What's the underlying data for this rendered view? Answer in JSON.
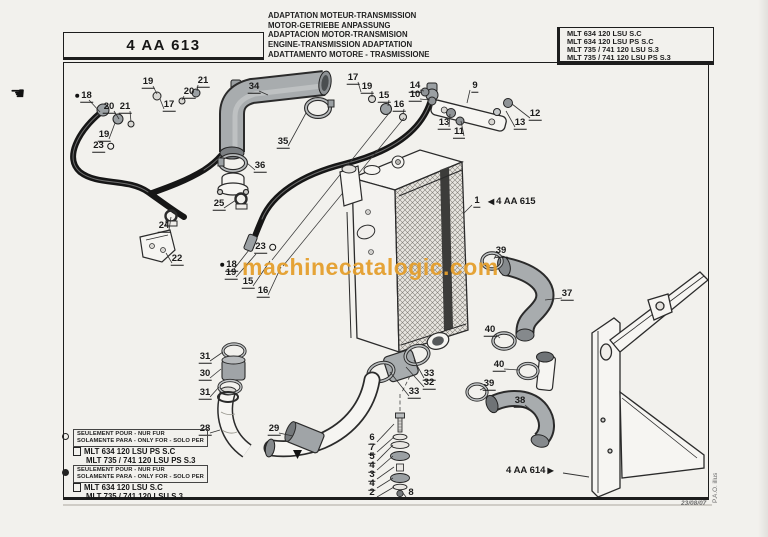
{
  "page": {
    "doc_ref": "4 AA 613",
    "titles": [
      "ADAPTATION MOTEUR-TRANSMISSION",
      "MOTOR-GETRIEBE ANPASSUNG",
      "ADAPTACION MOTOR-TRANSMISION",
      "ENGINE-TRANSMISSION ADAPTATION",
      "ADATTAMENTO MOTORE - TRASMISSIONE"
    ],
    "models": [
      "MLT 634 120 LSU  S.C",
      "MLT 634 120 LSU PS S.C",
      "MLT 735 / 741 120 LSU S.3",
      "MLT 735 / 741 120 LSU PS S.3"
    ],
    "footer_date": "23/08/07",
    "side_note": "P.A.O. illus"
  },
  "watermark": {
    "text": "machinecatalogic.com",
    "color": "#E49E2C"
  },
  "icons": {
    "hand": "☚",
    "arrow_left": "◀",
    "arrow_right": "▶"
  },
  "cross_refs": [
    {
      "part": "1",
      "text": "4 AA 615"
    },
    {
      "text": "4 AA 614"
    }
  ],
  "legend": [
    {
      "marker": "open-circle",
      "box_lines": [
        "SEULEMENT POUR - NUR FUR",
        "SOLAMENTE PARA - ONLY FOR - SOLO PER"
      ],
      "models": [
        "MLT 634 120 LSU PS S.C",
        "MLT 735 / 741 120 LSU PS S.3"
      ]
    },
    {
      "marker": "filled-circle",
      "box_lines": [
        "SEULEMENT POUR - NUR FUR",
        "SOLAMENTE PARA - ONLY FOR - SOLO PER"
      ],
      "models": [
        "MLT 634 120 LSU  S.C",
        "MLT 735 / 741 120 LSU S.3"
      ]
    }
  ],
  "callouts": [
    {
      "t": "18",
      "pre": "dot",
      "x": 84,
      "y": 96,
      "lx": 100,
      "ly": 112
    },
    {
      "t": "20",
      "x": 109,
      "y": 107,
      "lx": 119,
      "ly": 119
    },
    {
      "t": "21",
      "x": 125,
      "y": 107,
      "lx": 131,
      "ly": 122
    },
    {
      "t": "19",
      "x": 104,
      "y": 135,
      "lx": 115,
      "ly": 123
    },
    {
      "t": "23",
      "suf": "ring",
      "x": 103,
      "y": 146
    },
    {
      "t": "19",
      "x": 148,
      "y": 82,
      "lx": 157,
      "ly": 94
    },
    {
      "t": "21",
      "x": 203,
      "y": 81,
      "lx": 197,
      "ly": 91
    },
    {
      "t": "20",
      "x": 189,
      "y": 92,
      "lx": 182,
      "ly": 100
    },
    {
      "t": "17",
      "x": 169,
      "y": 105,
      "lx": 160,
      "ly": 99
    },
    {
      "t": "34",
      "x": 254,
      "y": 87,
      "lx": 268,
      "ly": 95
    },
    {
      "t": "35",
      "x": 283,
      "y": 142,
      "lx": 306,
      "ly": 113
    },
    {
      "t": "36",
      "x": 260,
      "y": 166,
      "lx": 247,
      "ly": 163
    },
    {
      "t": "17",
      "x": 353,
      "y": 78,
      "lx": 361,
      "ly": 92
    },
    {
      "t": "19",
      "x": 367,
      "y": 87,
      "lx": 372,
      "ly": 97
    },
    {
      "t": "15",
      "x": 384,
      "y": 96,
      "lx": 388,
      "ly": 106
    },
    {
      "t": "16",
      "x": 399,
      "y": 105,
      "lx": 403,
      "ly": 114
    },
    {
      "t": "14",
      "x": 415,
      "y": 86,
      "lx": 424,
      "ly": 91
    },
    {
      "t": "10",
      "x": 415,
      "y": 95,
      "lx": 430,
      "ly": 100
    },
    {
      "t": "9",
      "x": 475,
      "y": 86,
      "lx": 467,
      "ly": 103
    },
    {
      "t": "13",
      "x": 444,
      "y": 123,
      "lx": 450,
      "ly": 114
    },
    {
      "t": "11",
      "x": 459,
      "y": 132,
      "lx": 461,
      "ly": 121
    },
    {
      "t": "13",
      "x": 520,
      "y": 123,
      "lx": 506,
      "ly": 111
    },
    {
      "t": "12",
      "x": 535,
      "y": 114,
      "lx": 512,
      "ly": 104
    },
    {
      "t": "1",
      "x": 477,
      "y": 201,
      "lx": 463,
      "ly": 214
    },
    {
      "t": "25",
      "x": 219,
      "y": 204,
      "lx": 236,
      "ly": 200
    },
    {
      "t": "24",
      "x": 164,
      "y": 226,
      "lx": 171,
      "ly": 217
    },
    {
      "t": "22",
      "x": 177,
      "y": 259,
      "lx": 166,
      "ly": 253
    },
    {
      "t": "23",
      "suf": "ring",
      "x": 265,
      "y": 247
    },
    {
      "t": "18",
      "pre": "dot",
      "x": 229,
      "y": 265,
      "lx": 249,
      "ly": 250
    },
    {
      "t": "19",
      "x": 231,
      "y": 273,
      "lx": 256,
      "ly": 254
    },
    {
      "t": "15",
      "x": 248,
      "y": 282,
      "lx": 270,
      "ly": 261
    },
    {
      "t": "16",
      "x": 263,
      "y": 291,
      "lx": 281,
      "ly": 267
    },
    {
      "t": "39",
      "x": 501,
      "y": 251,
      "lx": 494,
      "ly": 259
    },
    {
      "t": "37",
      "x": 567,
      "y": 294,
      "lx": 545,
      "ly": 300
    },
    {
      "t": "40",
      "x": 490,
      "y": 330,
      "lx": 500,
      "ly": 338
    },
    {
      "t": "40",
      "x": 499,
      "y": 365,
      "lx": 519,
      "ly": 370
    },
    {
      "t": "39",
      "x": 489,
      "y": 384,
      "lx": 480,
      "ly": 390
    },
    {
      "t": "38",
      "x": 520,
      "y": 401,
      "lx": 531,
      "ly": 410
    },
    {
      "t": "31",
      "x": 205,
      "y": 357,
      "lx": 223,
      "ly": 352
    },
    {
      "t": "30",
      "x": 205,
      "y": 374,
      "lx": 221,
      "ly": 369
    },
    {
      "t": "31",
      "x": 205,
      "y": 393,
      "lx": 219,
      "ly": 387
    },
    {
      "t": "28",
      "x": 205,
      "y": 429,
      "lx": 220,
      "ly": 430
    },
    {
      "t": "29",
      "x": 274,
      "y": 429,
      "lx": 293,
      "ly": 436
    },
    {
      "t": "33",
      "x": 429,
      "y": 374,
      "lx": 414,
      "ly": 360
    },
    {
      "t": "32",
      "x": 429,
      "y": 383,
      "lx": 406,
      "ly": 367
    },
    {
      "t": "33",
      "x": 414,
      "y": 392,
      "lx": 390,
      "ly": 372
    },
    {
      "t": "6",
      "x": 372,
      "y": 438,
      "lx": 394,
      "ly": 424
    },
    {
      "t": "7",
      "x": 372,
      "y": 448,
      "lx": 394,
      "ly": 437
    },
    {
      "t": "5",
      "x": 372,
      "y": 457,
      "lx": 393,
      "ly": 445
    },
    {
      "t": "4",
      "x": 372,
      "y": 466,
      "lx": 393,
      "ly": 456
    },
    {
      "t": "3",
      "x": 372,
      "y": 475,
      "lx": 394,
      "ly": 467
    },
    {
      "t": "4",
      "x": 372,
      "y": 484,
      "lx": 393,
      "ly": 478
    },
    {
      "t": "2",
      "x": 372,
      "y": 493,
      "lx": 394,
      "ly": 487
    },
    {
      "t": "8",
      "x": 411,
      "y": 493,
      "lx": 403,
      "ly": 493
    }
  ]
}
